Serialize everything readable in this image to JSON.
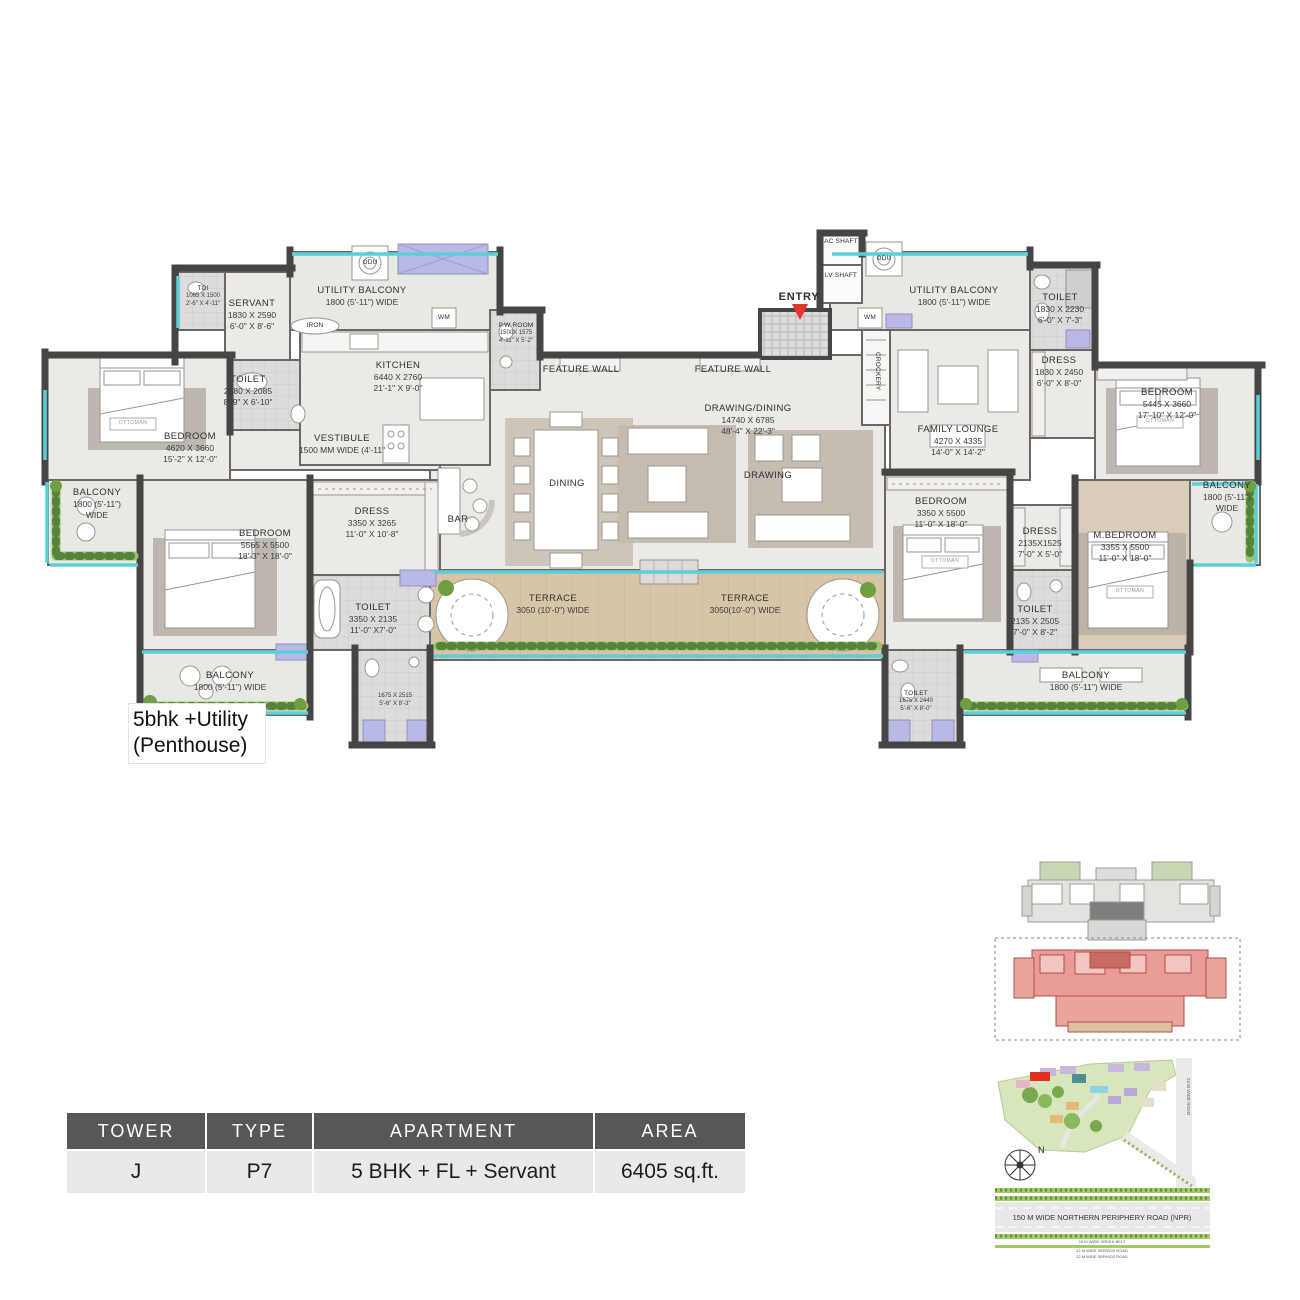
{
  "plan_label_line1": "5bhk +Utility",
  "plan_label_line2": "(Penthouse)",
  "rooms": {
    "toi": {
      "name": "TOI",
      "mm": "1065 X 1500",
      "ft": "2'-6\" X 4'-11\""
    },
    "servant": {
      "name": "SERVANT",
      "mm": "1830 X 2590",
      "ft": "6'-0\" X 8'-6\""
    },
    "utility_balcony_left": {
      "name": "UTILITY BALCONY",
      "mm": "1800 (5'-11\") WIDE"
    },
    "iron": {
      "name": "IRON"
    },
    "pw_room": {
      "name": "P.W ROOM",
      "mm": "1500X 1575",
      "ft": "4'-11\" X 5'-2\""
    },
    "kitchen": {
      "name": "KITCHEN",
      "mm": "6440 X 2760",
      "ft": "21'-1\" X 9'-0\""
    },
    "toilet_servant": {
      "name": "TOILET",
      "mm": "2680 X 2085",
      "ft": "8'-9\" X 6'-10\""
    },
    "bedroom2": {
      "name": "BEDROOM",
      "mm": "4620 X 3660",
      "ft": "15'-2\" X 12'-0\""
    },
    "vestibule": {
      "name": "VESTIBULE",
      "mm": "1500 MM WIDE (4'-11\""
    },
    "balcony_left": {
      "name": "BALCONY",
      "mm": "1800 (5'-11\")",
      "ft": "WIDE"
    },
    "bedroom3": {
      "name": "BEDROOM",
      "mm": "5565 X 5500",
      "ft": "18'-3\" X 18'-0\""
    },
    "dress3": {
      "name": "DRESS",
      "mm": "3350 X 3265",
      "ft": "11'-0\" X 10'-8\""
    },
    "bar": {
      "name": "BAR"
    },
    "toilet3": {
      "name": "TOILET",
      "mm": "3350 X 2135",
      "ft": "11'-0\" X7'-0\""
    },
    "balcony_bl": {
      "name": "BALCONY",
      "mm": "1800 (5'-11\") WIDE"
    },
    "toilet_left_small": {
      "mm": "1675 X 2515",
      "ft": "5'-6\" X 8'-3\""
    },
    "dining": {
      "name": "DINING"
    },
    "drawing_dining": {
      "name": "DRAWING/DINING",
      "mm": "14740 X 6785",
      "ft": "48'-4\" X 22'-3\""
    },
    "drawing": {
      "name": "DRAWING"
    },
    "feature_wall": {
      "name": "FEATURE WALL"
    },
    "terrace_left": {
      "name": "TERRACE",
      "mm": "3050 (10'-0\") WIDE"
    },
    "terrace_right": {
      "name": "TERRACE",
      "mm": "3050(10'-0\") WIDE"
    },
    "entry": {
      "name": "ENTRY"
    },
    "ac_shaft": {
      "name": "AC SHAFT"
    },
    "lv_shaft": {
      "name": "LV SHAFT"
    },
    "wm": {
      "name": "WM"
    },
    "odu": {
      "name": "ODU"
    },
    "crockery": {
      "name": "CROCKERY"
    },
    "utility_balcony_right": {
      "name": "UTILITY BALCONY",
      "mm": "1800 (5'-11\") WIDE"
    },
    "family_lounge": {
      "name": "FAMILY LOUNGE",
      "mm": "4270 X 4335",
      "ft": "14'-0\" X 14'-2\""
    },
    "toilet_r1": {
      "name": "TOILET",
      "mm": "1830 X 2230",
      "ft": "6'-0\" X 7'-3\""
    },
    "dress_r1": {
      "name": "DRESS",
      "mm": "1830 X 2450",
      "ft": "6'-0\" X 8'-0\""
    },
    "bedroom4": {
      "name": "BEDROOM",
      "mm": "5445 X 3660",
      "ft": "17'-10\" X 12'-0\""
    },
    "balcony_right": {
      "name": "BALCONY",
      "mm": "1800 (5'-11\")",
      "ft": "WIDE"
    },
    "bedroom5": {
      "name": "BEDROOM",
      "mm": "3350 X 5500",
      "ft": "11'-0\" X 18'-0\""
    },
    "dress_m": {
      "name": "DRESS",
      "mm": "2135X1525",
      "ft": "7'-0\" X 5'-0\""
    },
    "toilet_m": {
      "name": "TOILET",
      "mm": "2135 X 2505",
      "ft": "7'-0\" X 8'-2\""
    },
    "m_bedroom": {
      "name": "M.BEDROOM",
      "mm": "3355 X 5500",
      "ft": "11'-0\" X 18'-0\""
    },
    "toilet_br": {
      "name": "TOILET",
      "mm": "1675 X 2440",
      "ft": "5'-6\" X 8'-0\""
    },
    "balcony_br": {
      "name": "BALCONY",
      "mm": "1800 (5'-11\") WIDE"
    },
    "ottoman": {
      "name": "OTTOMAN"
    }
  },
  "table": {
    "headers": [
      "TOWER",
      "TYPE",
      "APARTMENT",
      "AREA"
    ],
    "row": [
      "J",
      "P7",
      "5 BHK + FL + Servant",
      "6405 sq.ft."
    ]
  },
  "site_plan": {
    "npr_road": "150 M  WIDE NORTHERN PERIPHERY ROAD (NPR)",
    "green_belt": "16 M WIDE GREEN BELT",
    "service_road_1": "12 M WIDE SERVICE ROAD",
    "service_road_2": "12 M WIDE SERVICE ROAD",
    "side_road": "24 M WIDE ROAD",
    "north": "N"
  },
  "colors": {
    "wall": "#474444",
    "floor": "#ebeae7",
    "terrace": "#d8c5a8",
    "glazing": "#5bcfd9",
    "plants": "#7fb057",
    "shower": "#b9b9e6",
    "entry_arrow": "#e8312a",
    "highlight_unit": "#e99c96",
    "table_header_bg": "#57575a",
    "table_row_bg": "#e9e9ea"
  }
}
